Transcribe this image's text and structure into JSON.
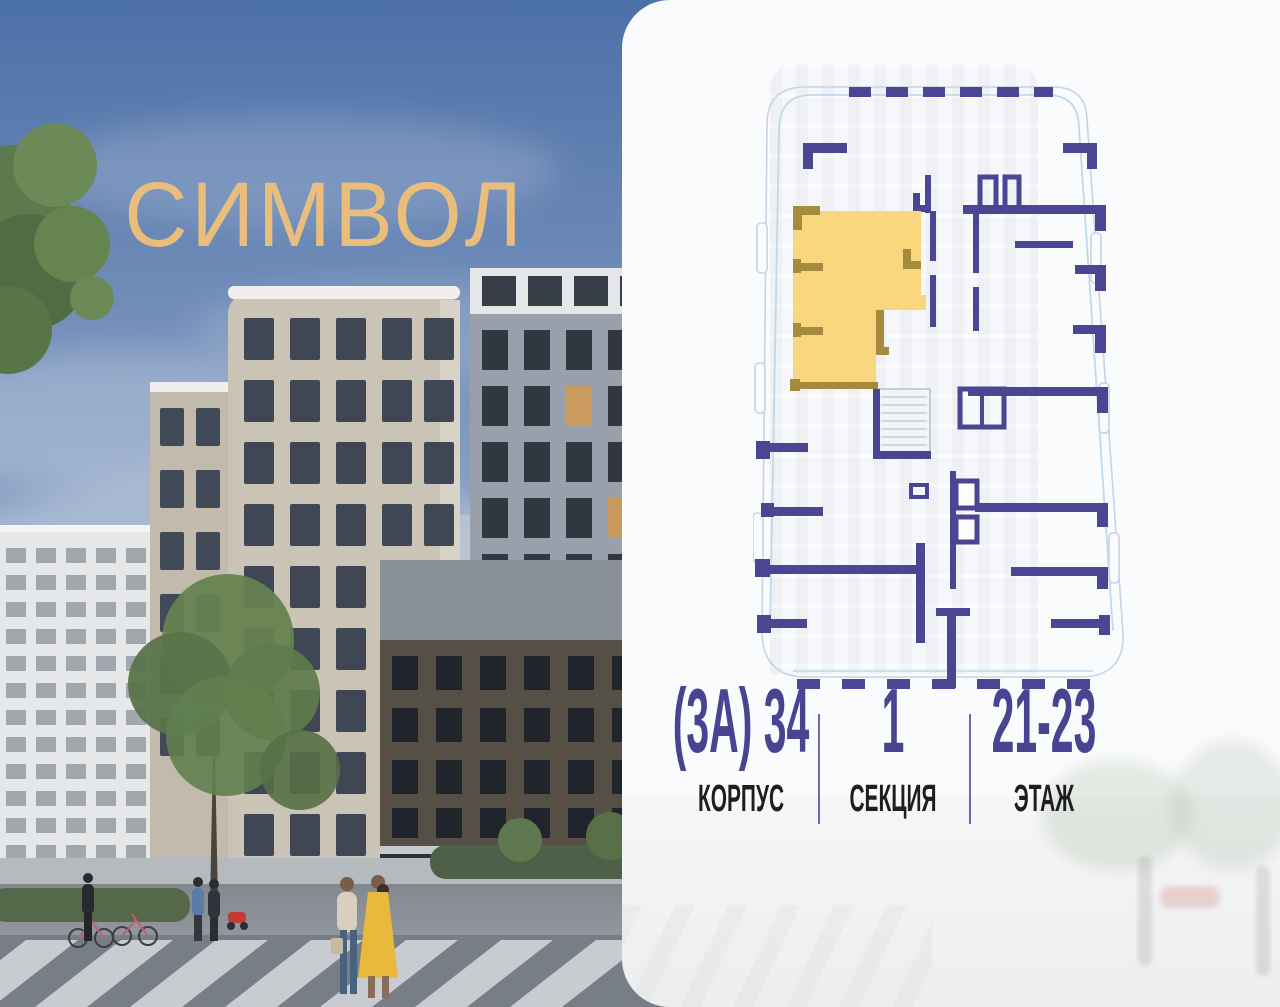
{
  "brand": {
    "logo_text": "СИМВОЛ",
    "logo_color": "#E9BE7D"
  },
  "panel": {
    "floor_plan": {
      "highlight_unit": "selected-apartment",
      "highlight_color": "#F8D77E",
      "highlight_wall_color": "#A68B3F",
      "wall_color": "#4B4593",
      "outline_color": "#C9D2E4",
      "glazing_color": "#BFD9EC"
    },
    "info": {
      "items": [
        {
          "value": "(3А) 34",
          "label": "КОРПУС"
        },
        {
          "value": "1",
          "label": "СЕКЦИЯ"
        },
        {
          "value": "21-23",
          "label": "ЭТАЖ"
        }
      ],
      "value_color": "#4A4392",
      "label_color": "#1E1E1E"
    }
  }
}
